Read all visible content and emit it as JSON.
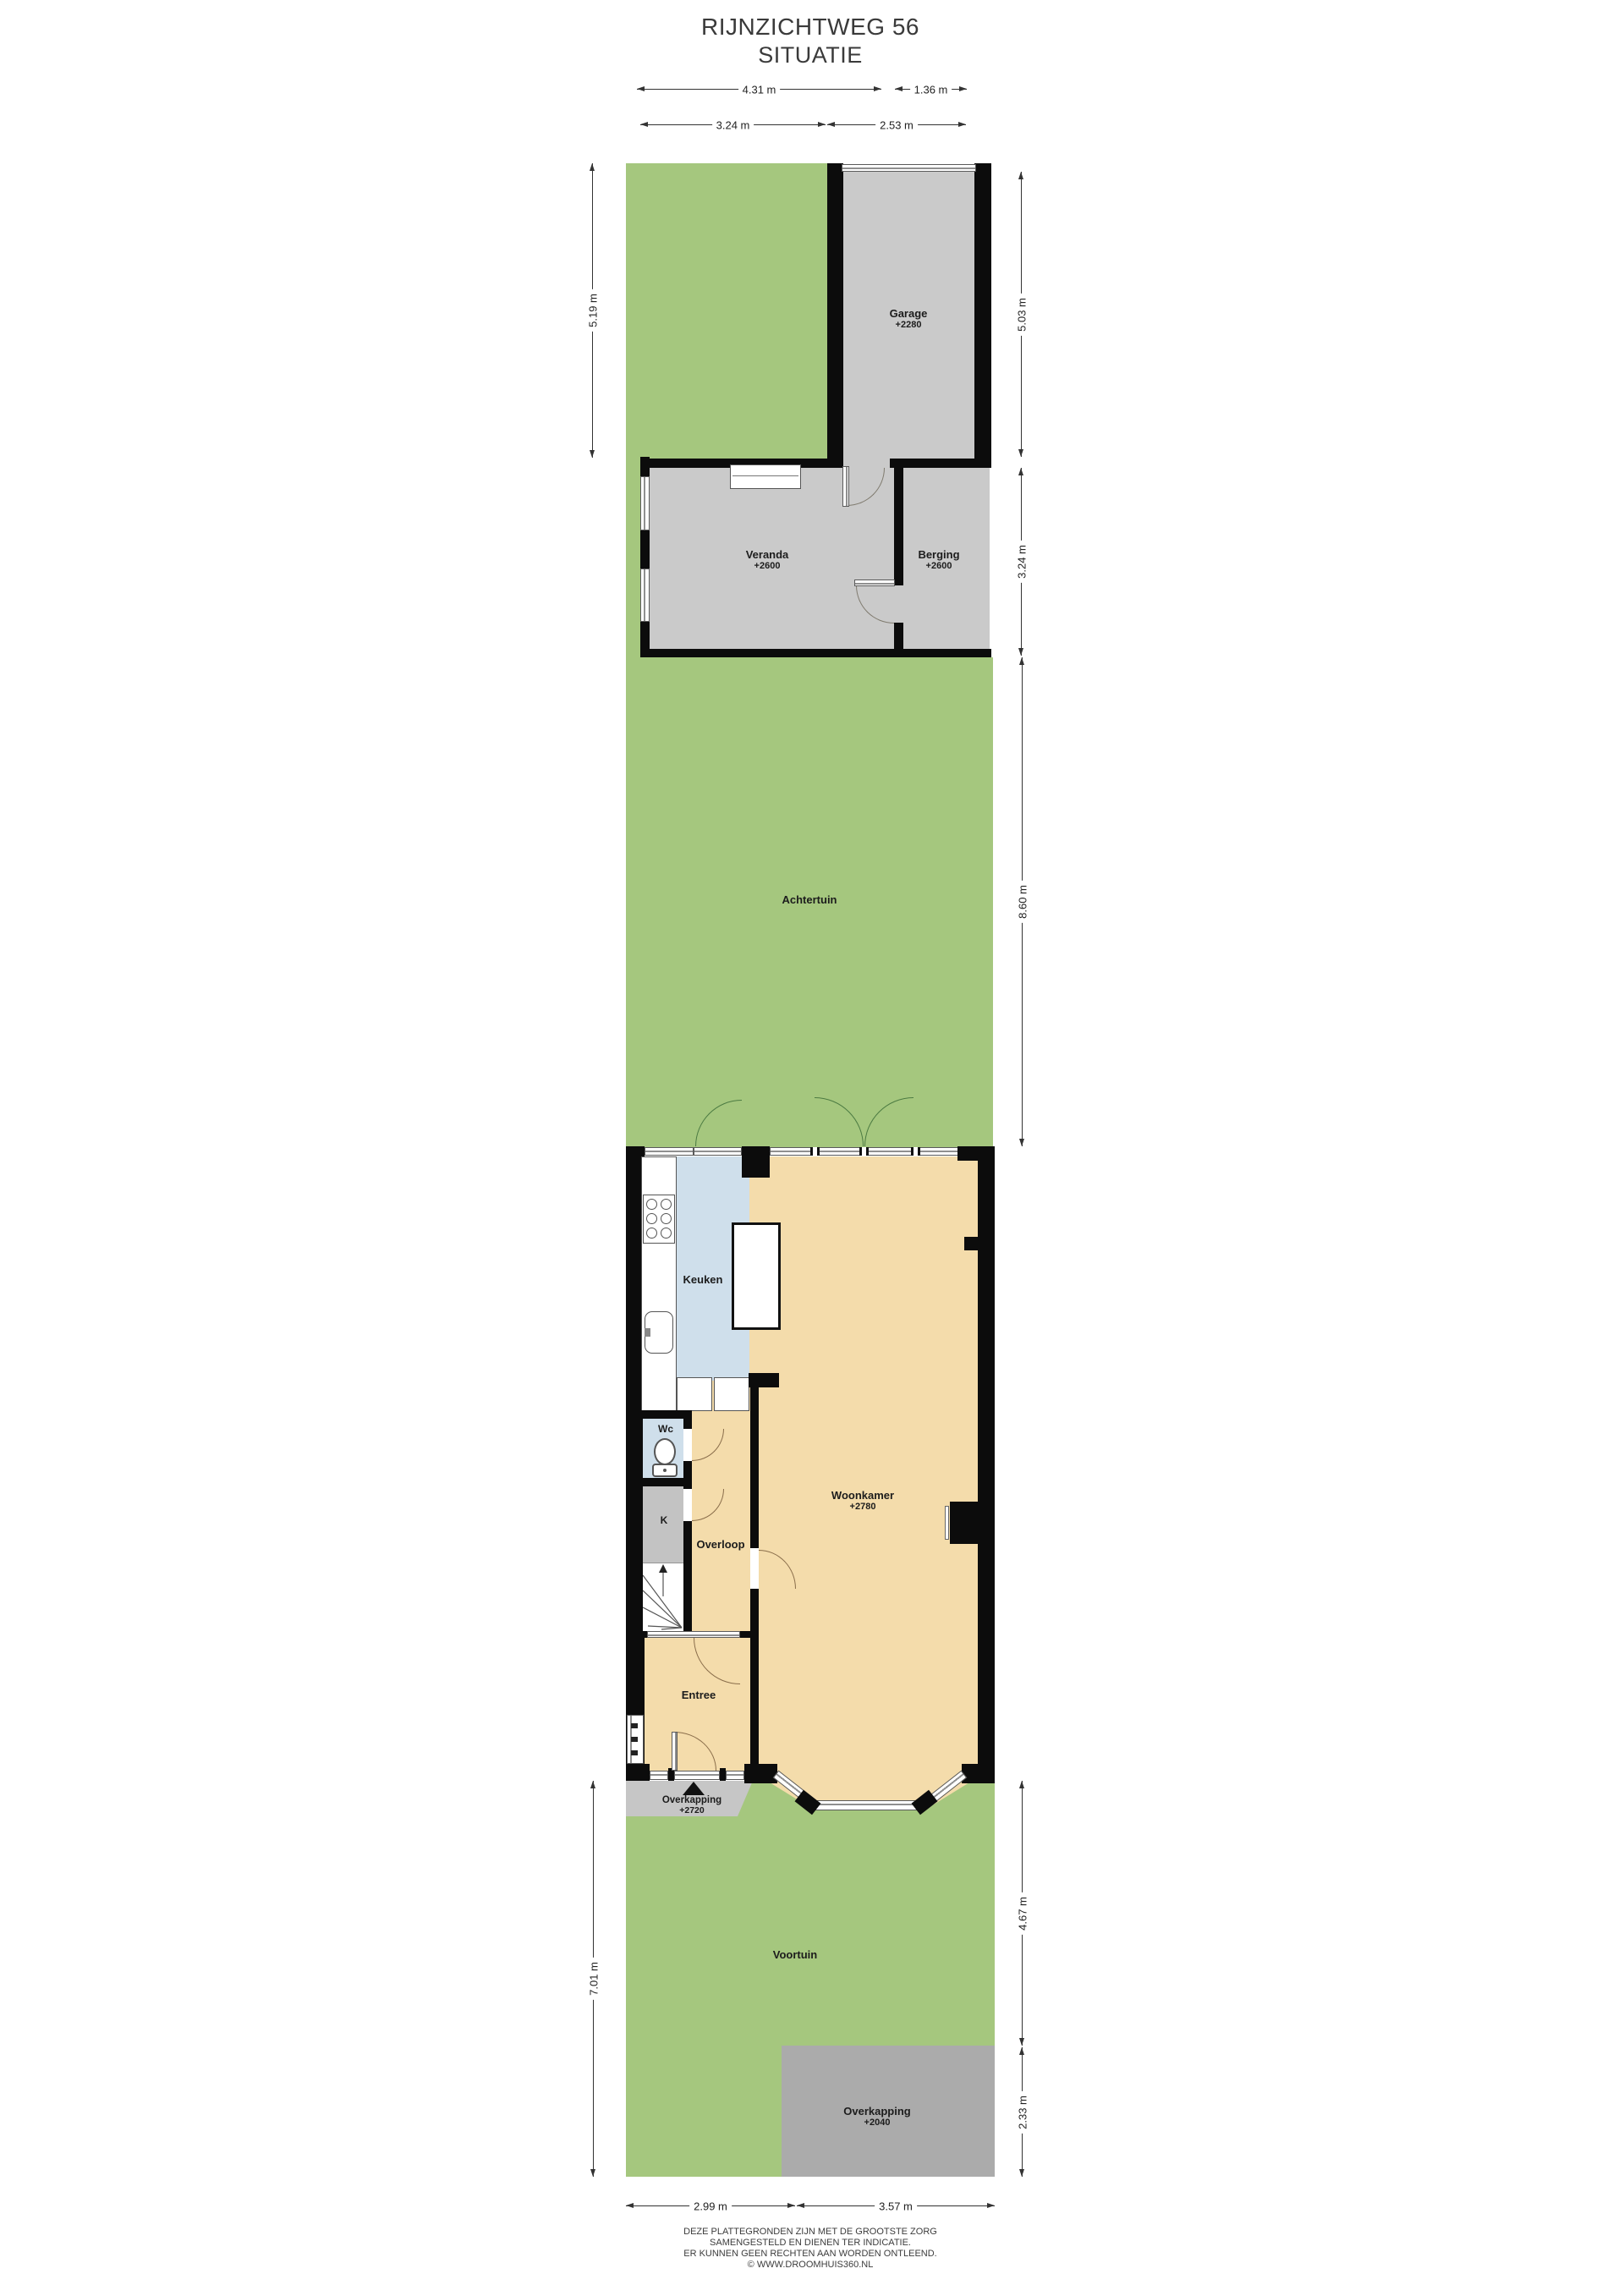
{
  "title": {
    "line1": "RIJNZICHTWEG 56",
    "line2": "SITUATIE"
  },
  "rooms": {
    "garage": {
      "name": "Garage",
      "elevation": "+2280"
    },
    "veranda": {
      "name": "Veranda",
      "elevation": "+2600"
    },
    "berging": {
      "name": "Berging",
      "elevation": "+2600"
    },
    "achtertuin": {
      "name": "Achtertuin"
    },
    "keuken": {
      "name": "Keuken"
    },
    "woonkamer": {
      "name": "Woonkamer",
      "elevation": "+2780"
    },
    "wc": {
      "name": "Wc"
    },
    "kast": {
      "name": "K"
    },
    "overloop": {
      "name": "Overloop"
    },
    "entree": {
      "name": "Entree"
    },
    "overkapping_entree": {
      "name": "Overkapping",
      "elevation": "+2720"
    },
    "voortuin": {
      "name": "Voortuin"
    },
    "overkapping_voortuin": {
      "name": "Overkapping",
      "elevation": "+2040"
    }
  },
  "dimensions": {
    "top": [
      "4.31 m",
      "1.36 m",
      "3.24 m",
      "2.53 m"
    ],
    "left": [
      "5.19 m",
      "7.01 m"
    ],
    "right": [
      "5.03 m",
      "3.24 m",
      "8.60 m",
      "4.67 m",
      "2.33 m"
    ],
    "bottom": [
      "2.99 m",
      "3.57 m"
    ]
  },
  "footer": [
    "DEZE PLATTEGRONDEN ZIJN MET DE GROOTSTE ZORG",
    "SAMENGESTELD EN DIENEN TER INDICATIE.",
    "ER KUNNEN GEEN RECHTEN AAN WORDEN ONTLEEND.",
    "© WWW.DROOMHUIS360.NL"
  ],
  "colors": {
    "garden": "#a5c77e",
    "building_gray": "#cacaca",
    "floor_tan": "#f4dcab",
    "floor_blue": "#cfdfeb",
    "closet_gray": "#c3c3c3",
    "canopy_front": "#c6c6c6",
    "canopy_drive": "#ababab",
    "wall": "#0c0c0c"
  }
}
